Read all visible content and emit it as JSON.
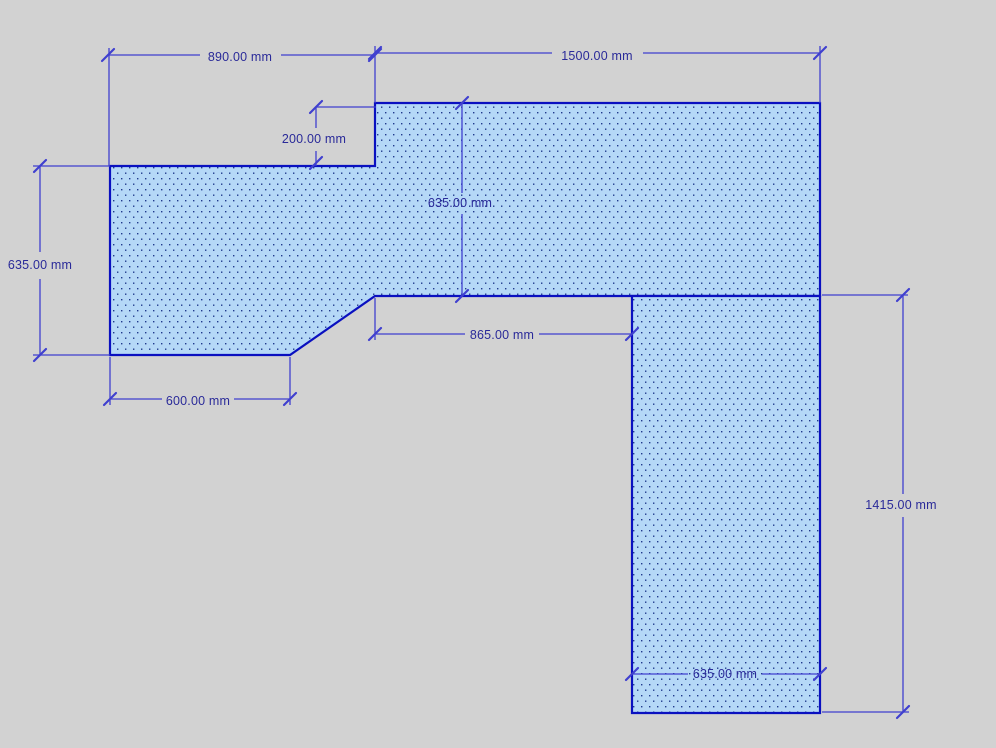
{
  "drawing": {
    "unit": "mm",
    "colors": {
      "background": "#d2d2d2",
      "piece_fill": "#b5d8f7",
      "piece_dots": "#203a8c",
      "piece_outline": "#0a10c0",
      "dimension_lines": "#4040cf",
      "dimension_text": "#2a2a99"
    },
    "pieces": [
      {
        "id": "top-l-piece"
      },
      {
        "id": "right-column-piece"
      }
    ],
    "dimensions": [
      {
        "id": "top-left-width",
        "label": "890.00 mm"
      },
      {
        "id": "top-right-width",
        "label": "1500.00 mm"
      },
      {
        "id": "notch-depth",
        "label": "200.00 mm"
      },
      {
        "id": "left-section-depth",
        "label": "635.00 mm"
      },
      {
        "id": "top-section-depth",
        "label": "635.00 mm"
      },
      {
        "id": "bottom-left-width",
        "label": "600.00 mm"
      },
      {
        "id": "inner-edge-width",
        "label": "865.00 mm"
      },
      {
        "id": "right-section-height",
        "label": "1415.00 mm"
      },
      {
        "id": "right-section-width",
        "label": "635.00 mm"
      }
    ]
  }
}
